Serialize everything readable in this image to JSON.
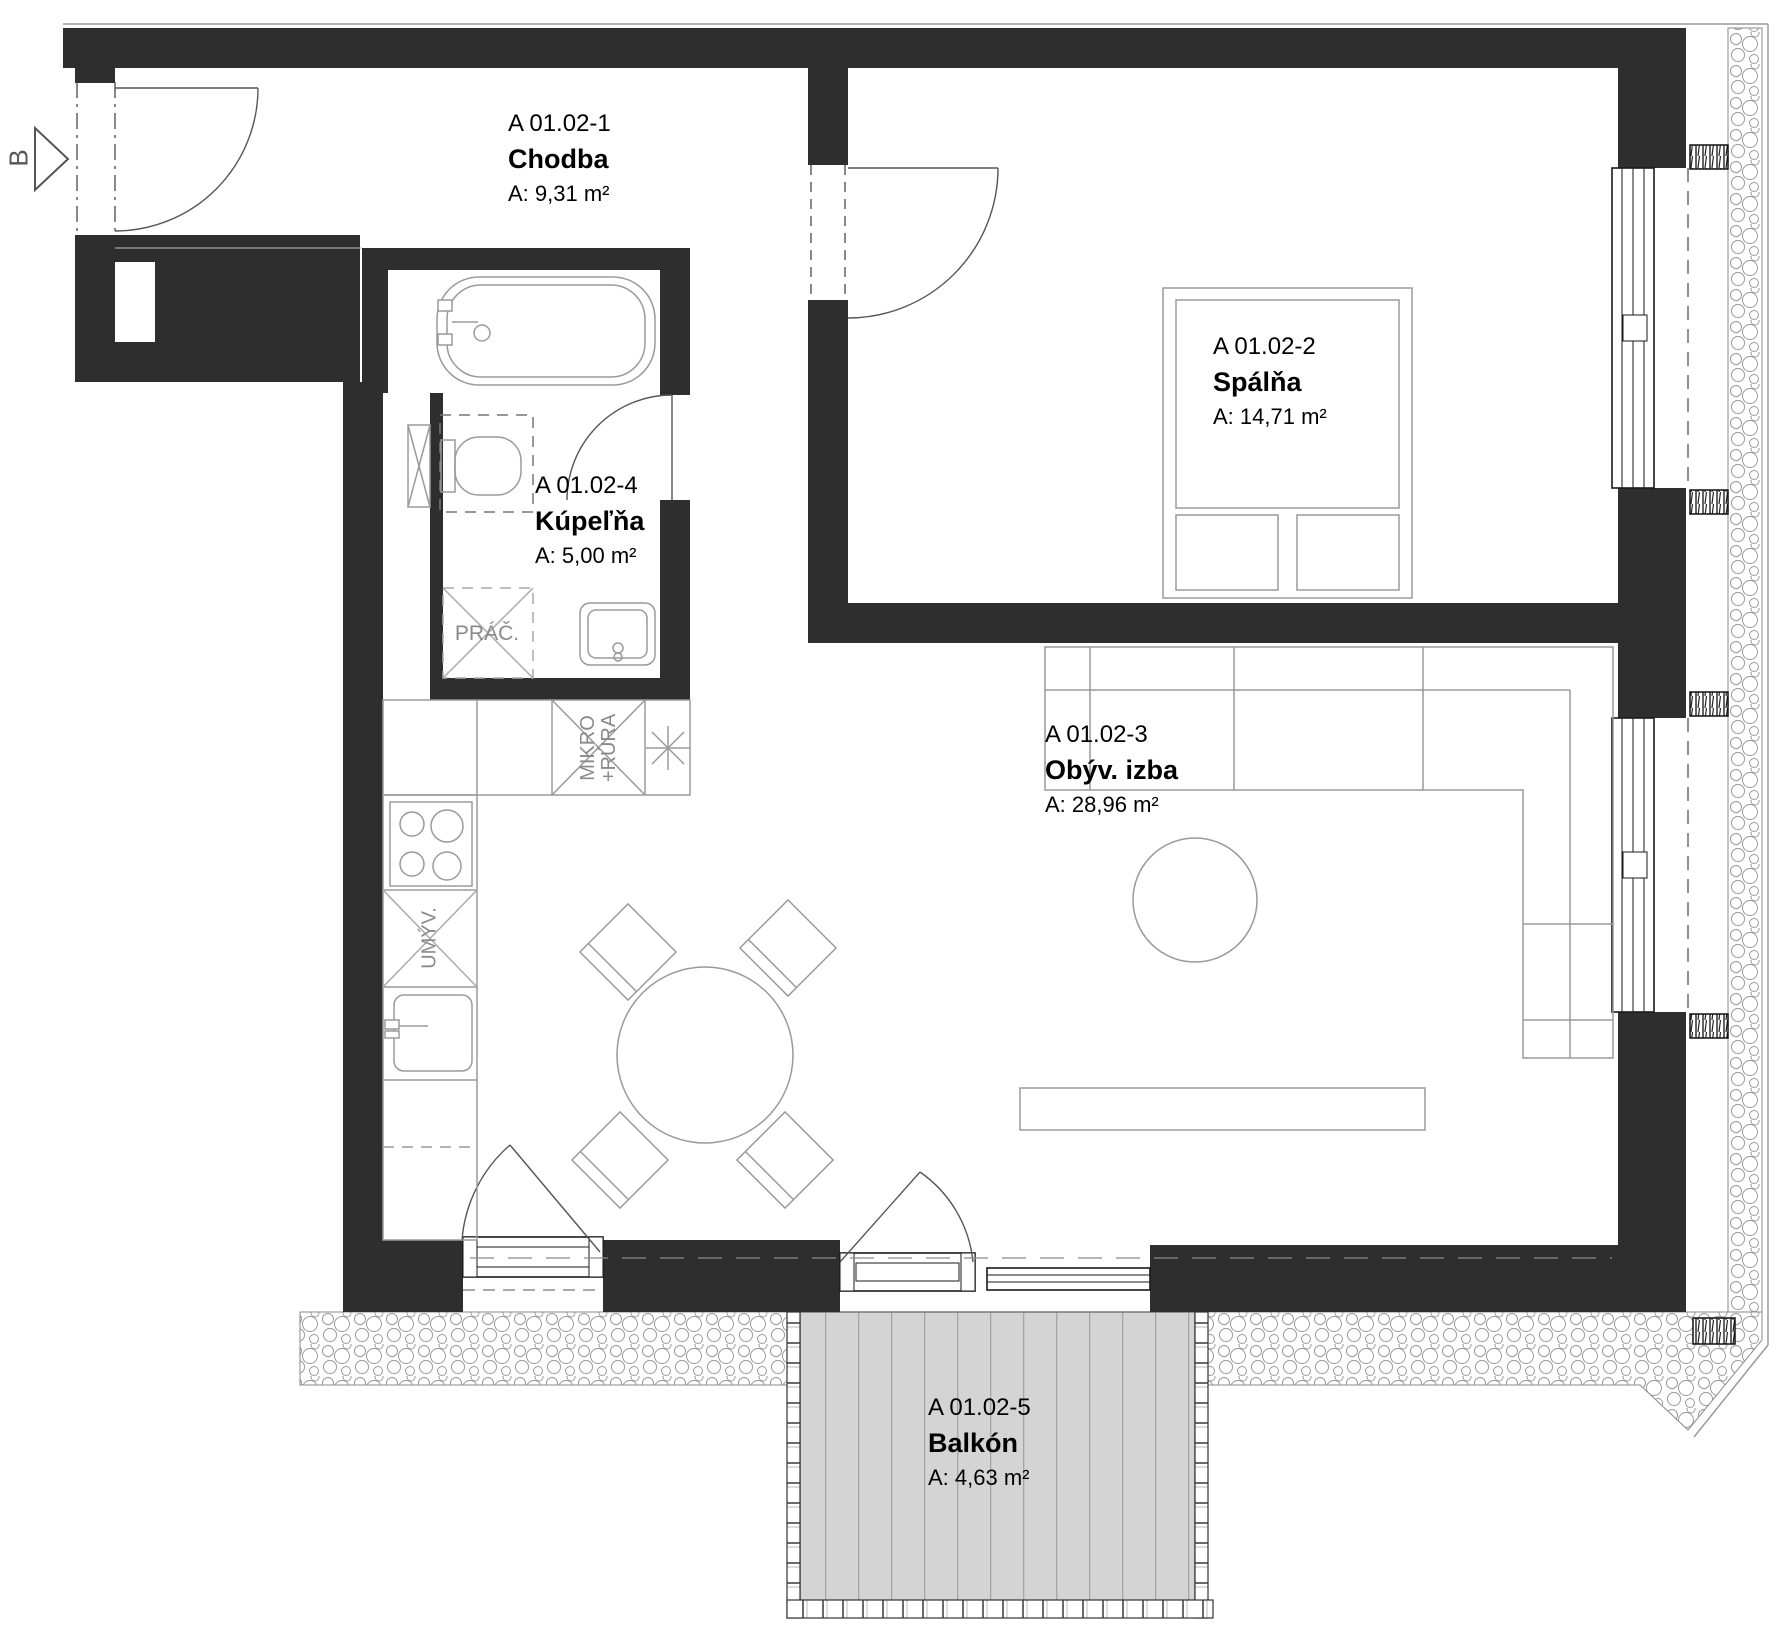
{
  "section_marker": {
    "label": "B"
  },
  "rooms": [
    {
      "id": "A 01.02-1",
      "name": "Chodba",
      "area": "A: 9,31 m²"
    },
    {
      "id": "A 01.02-2",
      "name": "Spálňa",
      "area": "A: 14,71 m²"
    },
    {
      "id": "A 01.02-3",
      "name": "Obýv. izba",
      "area": "A: 28,96 m²"
    },
    {
      "id": "A 01.02-4",
      "name": "Kúpeľňa",
      "area": "A: 5,00 m²"
    },
    {
      "id": "A 01.02-5",
      "name": "Balkón",
      "area": "A: 4,63 m²"
    }
  ],
  "fixtures": {
    "washer": "PRÁČ.",
    "micro_oven": "MIKRO\n+RÚRA",
    "dishwasher": "UMÝV."
  },
  "colors": {
    "wall": "#2e2e2e",
    "fixture_line": "#9a9a9a",
    "deck_fill": "#d4d4d4",
    "deck_line": "#a5a5a5",
    "text": "#000000",
    "fixture_text": "#8a8a8a"
  }
}
